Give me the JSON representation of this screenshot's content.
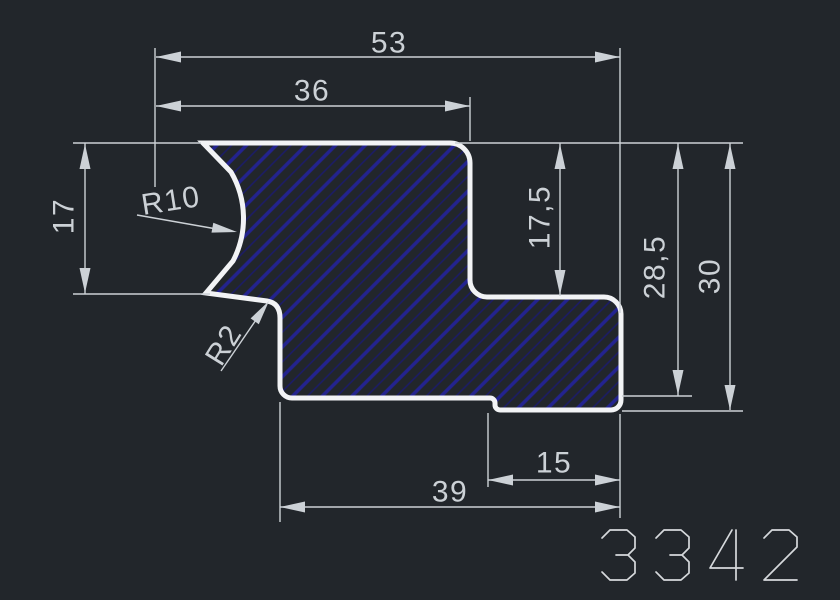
{
  "drawing": {
    "part_number": "3342",
    "dims": {
      "total_width": "53",
      "top_width": "36",
      "left_height": "17",
      "step_height": "17,5",
      "right_inner_height": "28,5",
      "right_outer_height": "30",
      "bottom_inner_width": "15",
      "bottom_width": "39",
      "radius_large": "R10",
      "radius_small": "R2"
    },
    "colors": {
      "background": "#22262b",
      "outline": "#f2f3f5",
      "dimension": "#ccd1d6",
      "hatch_bold": "#23238f",
      "hatch_faint": "#1b1b69",
      "part_number_color": "#d6d9dc"
    }
  }
}
